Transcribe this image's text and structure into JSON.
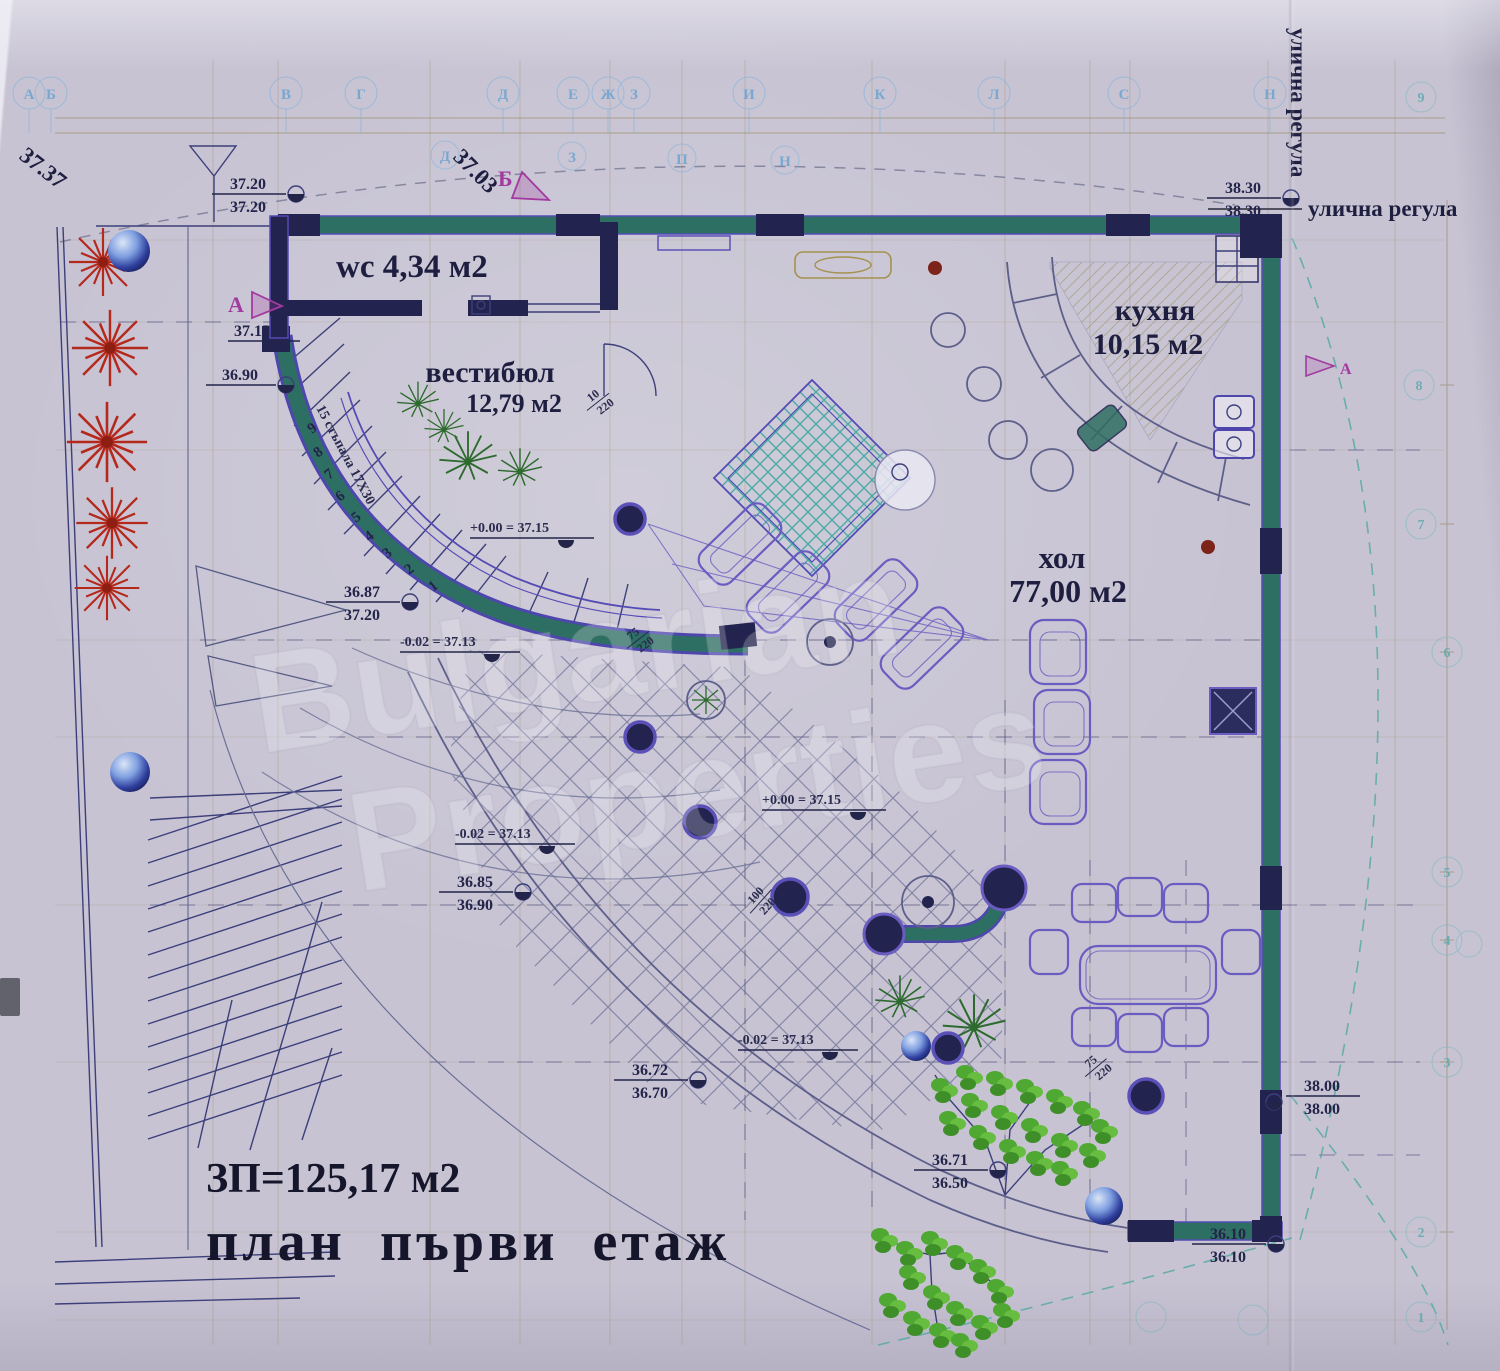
{
  "document": {
    "built_area": "ЗП=125,17 м2",
    "plan_title": "план първи етаж",
    "street_regulation": "улична регула",
    "street_regulation_side": "улична регула"
  },
  "rooms": {
    "wc_label": "wc 4,34 м2",
    "vestibule_name": "вестибюл",
    "vestibule_area": "12,79 м2",
    "kitchen_name": "кухня",
    "kitchen_area": "10,15 м2",
    "living_name": "хол",
    "living_area": "77,00 м2"
  },
  "stairs": {
    "note": "15 стъпала 17X30",
    "steps": [
      "1",
      "2",
      "3",
      "4",
      "5",
      "6",
      "7",
      "8",
      "9"
    ]
  },
  "levels": {
    "zero": "+0.00 = 37.15",
    "minus": "-0.02 = 37.13"
  },
  "site": {
    "corner_level": "37.37",
    "arc_level": "37.03"
  },
  "sections": {
    "a": "А",
    "a_level": "37.15",
    "b": "Б",
    "a_right": "А"
  },
  "elev": [
    {
      "t": "37.20",
      "b": "37.20"
    },
    {
      "t": "38.30",
      "b": "38.30"
    },
    {
      "t": "36.87",
      "b": "37.20"
    },
    {
      "t": "36.85",
      "b": "36.90"
    },
    {
      "t": "36.72",
      "b": "36.70"
    },
    {
      "t": "36.71",
      "b": "36.50"
    },
    {
      "t": "38.00",
      "b": "38.00"
    },
    {
      "t": "36.10",
      "b": "36.10"
    },
    {
      "t": "36.90",
      "b": ""
    }
  ],
  "dims": {
    "d1n": "10",
    "d1d": "220",
    "d2n": "75",
    "d2d": "220",
    "d3n": "100",
    "d3d": "220"
  },
  "axes": {
    "top": [
      "А",
      "Б",
      "В",
      "Г",
      "Д",
      "Е",
      "Ж",
      "З",
      "И",
      "К",
      "Л",
      "С",
      "Н"
    ],
    "inner": [
      "Д",
      "З",
      "П",
      "Н"
    ],
    "right": [
      "9",
      "8",
      "7",
      "6",
      "5",
      "4",
      "3",
      "2",
      "1"
    ]
  },
  "watermark": [
    "Bulgarian",
    "Properties"
  ]
}
